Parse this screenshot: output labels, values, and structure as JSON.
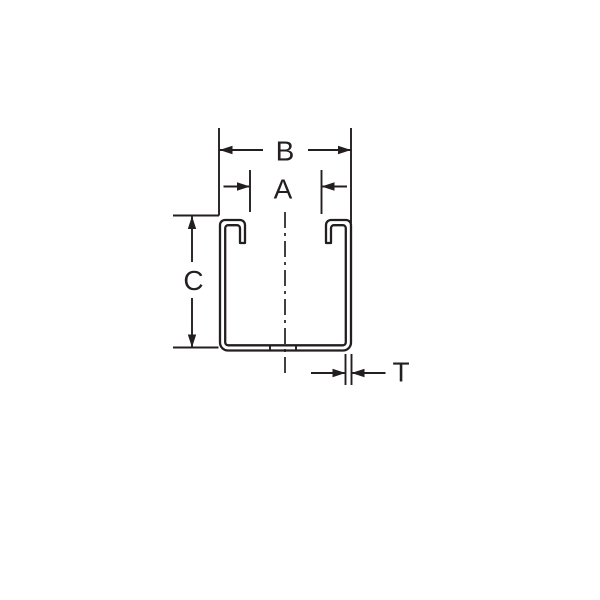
{
  "diagram": {
    "background_color": "#ffffff",
    "line_color": "#231f20",
    "part": "strut-channel-cross-section",
    "labels": {
      "overall_width": "B",
      "opening_width": "A",
      "height": "C",
      "thickness": "T"
    }
  }
}
